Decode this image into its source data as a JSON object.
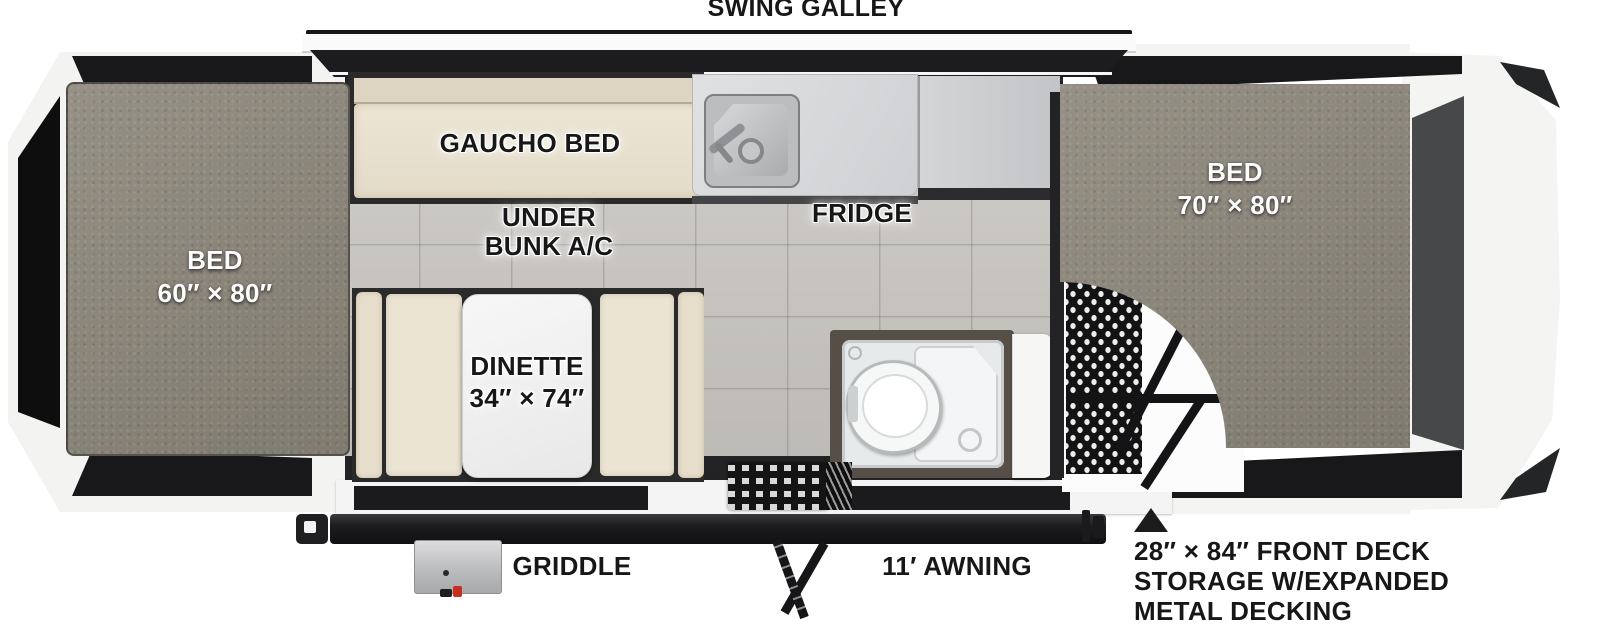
{
  "diagram": {
    "type": "travel-trailer-floorplan",
    "headline_feature": "SWING GALLEY"
  },
  "labels": {
    "swing_galley": "SWING GALLEY",
    "left_bed": {
      "label": "BED",
      "dimensions": "60″ × 80″"
    },
    "right_bed": {
      "label": "BED",
      "dimensions": "70″ × 80″"
    },
    "gaucho_bed": "GAUCHO BED",
    "under_bunk_ac": {
      "line1": "UNDER",
      "line2": "BUNK A/C"
    },
    "fridge": "FRIDGE",
    "dinette": {
      "label": "DINETTE",
      "dimensions": "34″ × 74″"
    },
    "griddle": "GRIDDLE",
    "awning": "11′ AWNING",
    "front_deck_note": {
      "line1": "28″ × 84″ FRONT DECK",
      "line2": "STORAGE W/EXPANDED",
      "line3": "METAL DECKING"
    }
  },
  "colors": {
    "canvas_black": "#18181a",
    "mattress_grey": "#8e887c",
    "cushion_cream": "#ebe4d3",
    "tile_floor": "#c9c6c1",
    "counter_grey": "#d7d8da",
    "tent_panel_right": "#474849",
    "shell_white": "#f4f4f3",
    "switch_red": "#c92f20"
  }
}
